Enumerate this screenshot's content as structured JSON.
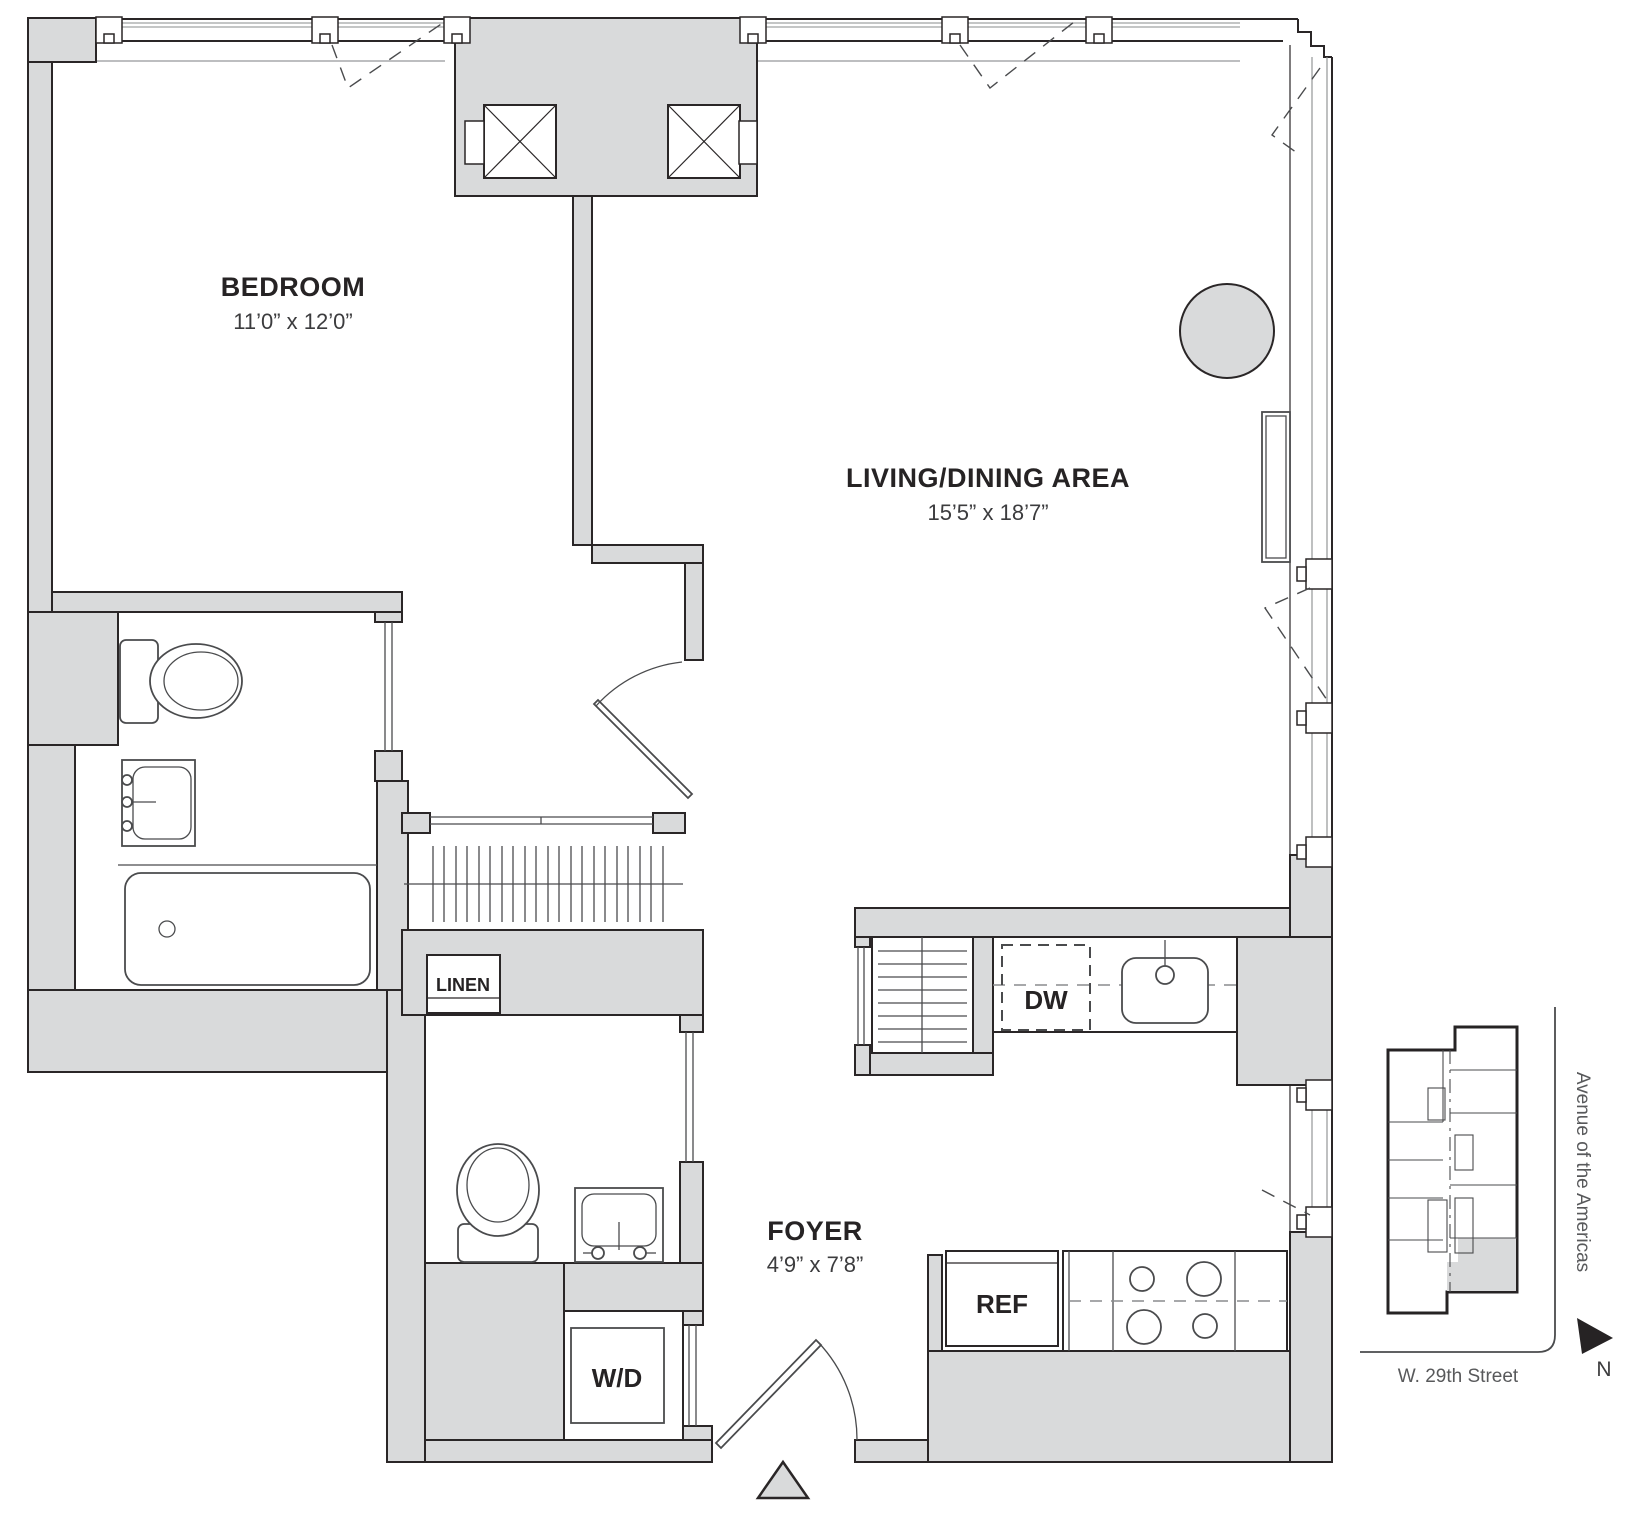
{
  "plan": {
    "type": "residential floor plan",
    "rooms": {
      "bedroom": {
        "label": "BEDROOM",
        "dimensions": "11’0” x 12’0”"
      },
      "living": {
        "label": "LIVING/DINING AREA",
        "dimensions": "15’5” x 18’7”"
      },
      "foyer": {
        "label": "FOYER",
        "dimensions": "4’9” x 7’8”"
      }
    },
    "closets": {
      "linen": {
        "label": "LINEN"
      }
    },
    "appliances": {
      "washer_dryer": {
        "label": "W/D"
      },
      "dishwasher": {
        "label": "DW"
      },
      "refrigerator": {
        "label": "REF"
      }
    },
    "keyplan": {
      "avenue_label": "Avenue of the Americas",
      "street_label": "W. 29th Street",
      "north_label": "N"
    },
    "colors": {
      "wall_fill": "#d9dadb",
      "outline": "#2a2627",
      "fixture_line": "#4a4b4d",
      "glass_line": "#8a8c8e",
      "sill_line": "#a7a9ac",
      "text_dark": "#262324",
      "text_gray": "#58595b"
    }
  }
}
